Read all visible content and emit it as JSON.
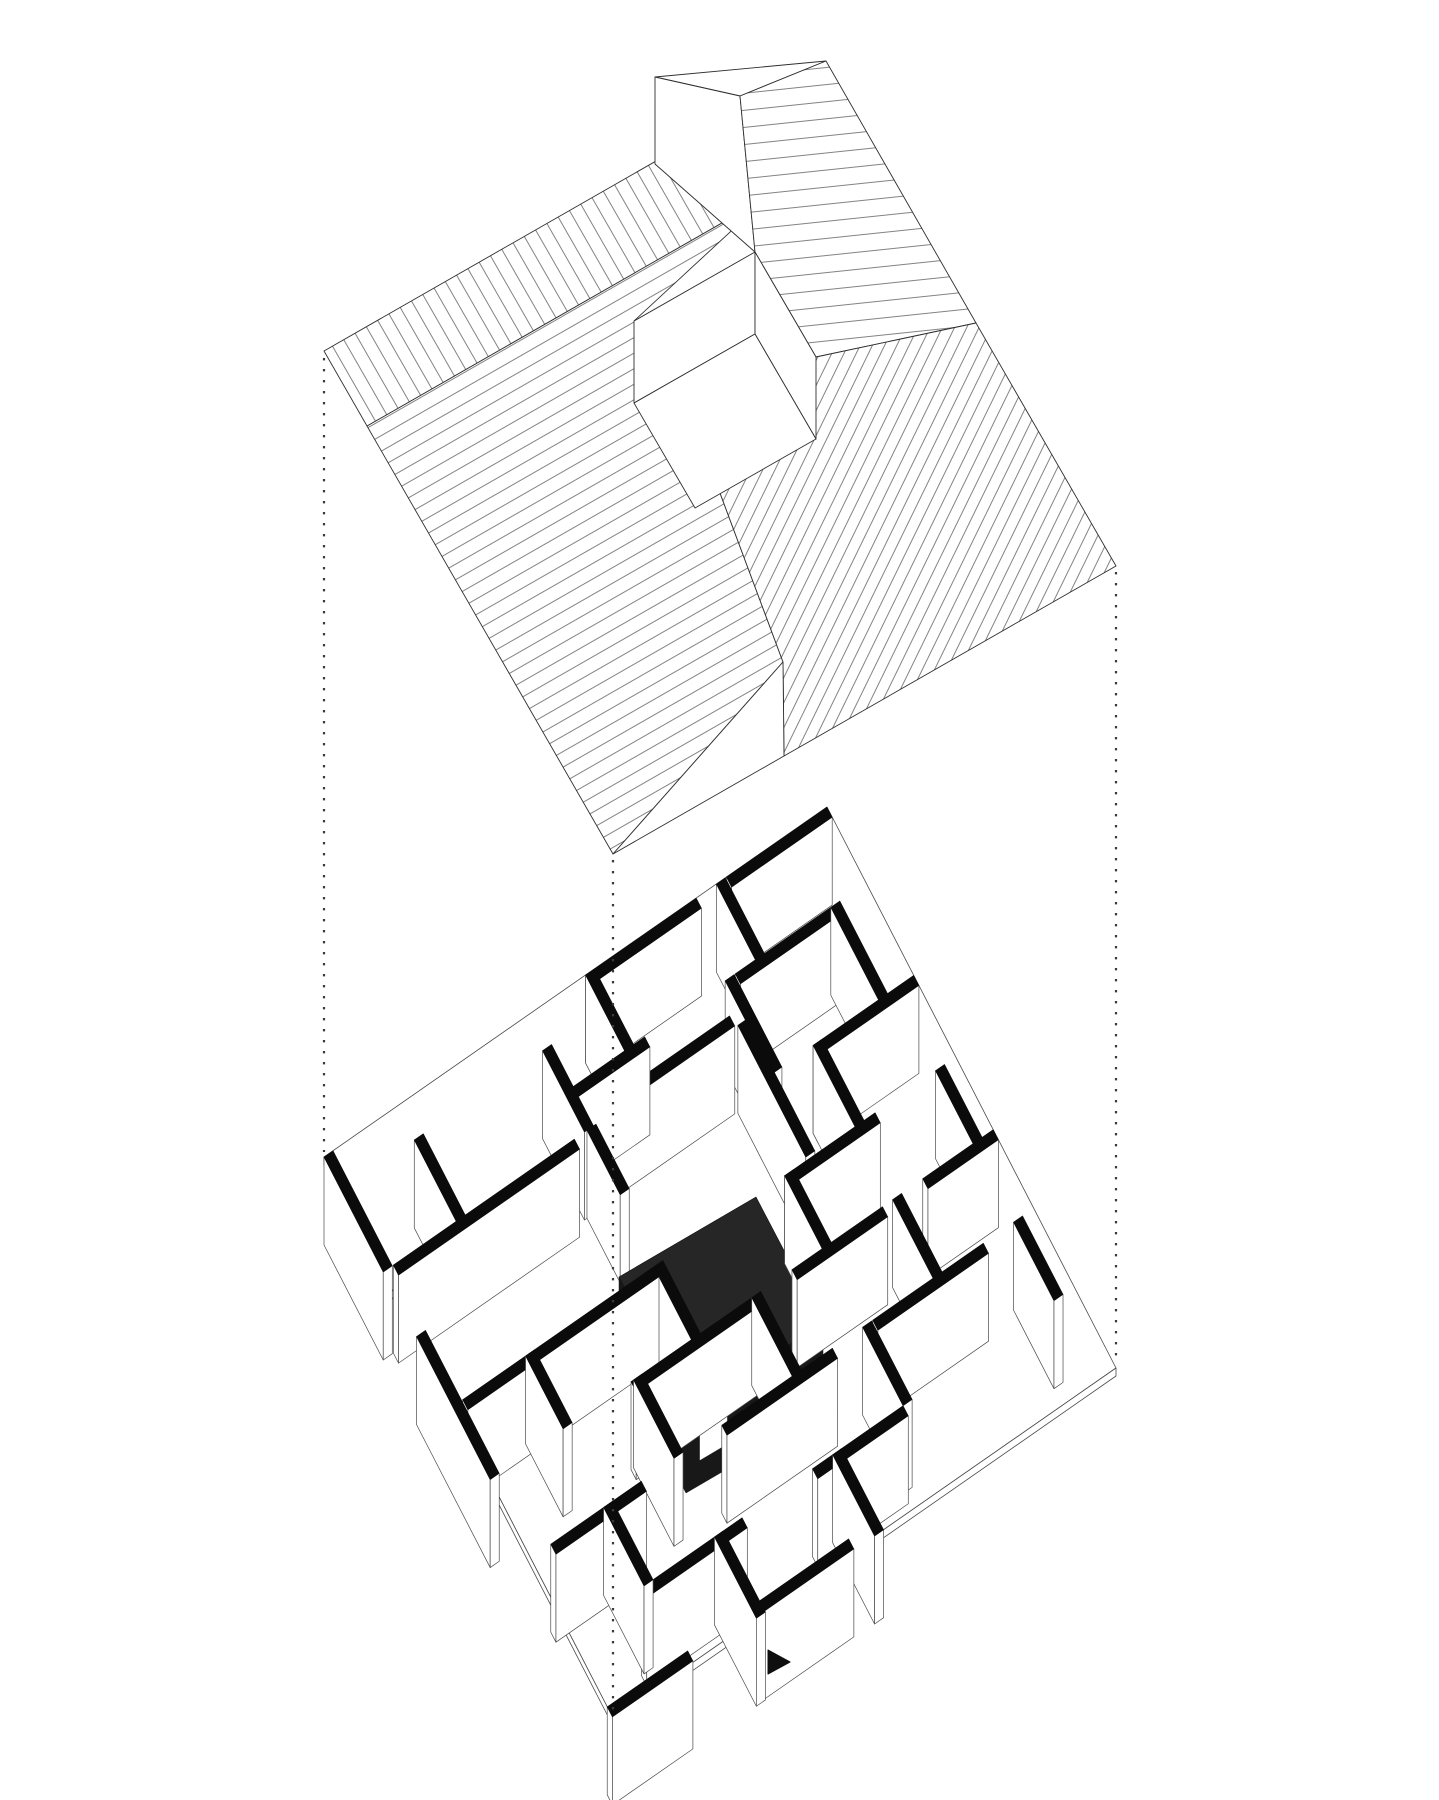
{
  "canvas": {
    "width": 1439,
    "height": 1800,
    "background": "#ffffff"
  },
  "colors": {
    "line": "#2f2f2f",
    "thin_line": "#4a4a4a",
    "hatch_line": "#5a5a5a",
    "wall_cap": "#0b0b0b",
    "wall_face": "#ffffff",
    "roof_face": "#ffffff",
    "box_top": "#262626",
    "box_face": "#181818",
    "dot": "#3a3a3a",
    "marker": "#0f0f0f"
  },
  "roof": {
    "hatches": [
      {
        "id": "hu",
        "angle": -29.8,
        "spacing": 13.5
      },
      {
        "id": "hv",
        "angle": 60.2,
        "spacing": 13
      },
      {
        "id": "hne",
        "angle": -6,
        "spacing": 17
      },
      {
        "id": "hse",
        "angle": -64,
        "spacing": 11
      }
    ],
    "planes": [
      {
        "name": "roof-slope-sw",
        "hatch": "hu",
        "points": [
          [
            367,
            426
          ],
          [
            769,
            196
          ],
          [
            634,
            321
          ],
          [
            695,
            426
          ],
          [
            783,
            662
          ],
          [
            613,
            854
          ]
        ]
      },
      {
        "name": "roof-slope-nw-band",
        "hatch": "hv",
        "points": [
          [
            324,
            351
          ],
          [
            726,
            121
          ],
          [
            769,
            196
          ],
          [
            367,
            426
          ]
        ]
      },
      {
        "name": "roof-slope-ne-far",
        "hatch": null,
        "points": [
          [
            655,
            77
          ],
          [
            826,
            61
          ],
          [
            740,
            96
          ]
        ]
      },
      {
        "name": "roof-gable-ne",
        "hatch": null,
        "points": [
          [
            655,
            77
          ],
          [
            655,
            164
          ],
          [
            755,
            252
          ],
          [
            740,
            96
          ]
        ]
      },
      {
        "name": "roof-slope-ne",
        "hatch": "hne",
        "points": [
          [
            740,
            96
          ],
          [
            826,
            61
          ],
          [
            976,
            323
          ],
          [
            816,
            357
          ],
          [
            755,
            252
          ]
        ]
      },
      {
        "name": "roof-slope-se",
        "hatch": "hse",
        "points": [
          [
            976,
            323
          ],
          [
            1116,
            566
          ],
          [
            784,
            756
          ],
          [
            783,
            662
          ],
          [
            695,
            426
          ],
          [
            816,
            357
          ]
        ]
      },
      {
        "name": "roof-gable-south",
        "hatch": null,
        "points": [
          [
            783,
            662
          ],
          [
            784,
            756
          ],
          [
            613,
            854
          ]
        ]
      },
      {
        "name": "courtyard-wall-nw",
        "hatch": null,
        "points": [
          [
            634,
            321
          ],
          [
            755,
            252
          ],
          [
            755,
            334
          ],
          [
            634,
            403
          ]
        ]
      },
      {
        "name": "courtyard-wall-ne",
        "hatch": null,
        "points": [
          [
            755,
            252
          ],
          [
            816,
            357
          ],
          [
            816,
            439
          ],
          [
            755,
            334
          ]
        ]
      },
      {
        "name": "courtyard-floor",
        "hatch": null,
        "points": [
          [
            634,
            403
          ],
          [
            755,
            334
          ],
          [
            816,
            439
          ],
          [
            695,
            508
          ]
        ]
      }
    ]
  },
  "plan": {
    "origin": [
      324,
      1157
    ],
    "axis_u": [
      503,
      -350
    ],
    "axis_v": [
      289,
      561
    ],
    "wall_height": 88,
    "cap_width": 0.018,
    "slab_thickness": 8,
    "walls_u": [
      [
        0.0,
        0.52,
        0.74
      ],
      [
        0.0,
        0.8,
        1.0
      ],
      [
        0.135,
        0.4,
        0.56
      ],
      [
        0.135,
        0.74,
        0.93
      ],
      [
        0.185,
        0.44,
        0.7
      ],
      [
        0.205,
        0.02,
        0.38
      ],
      [
        0.3,
        0.8,
        1.0
      ],
      [
        0.445,
        0.02,
        0.4
      ],
      [
        0.445,
        0.66,
        0.84
      ],
      [
        0.575,
        0.28,
        0.52
      ],
      [
        0.575,
        0.6,
        0.78
      ],
      [
        0.575,
        0.86,
        1.0
      ],
      [
        0.715,
        0.04,
        0.22
      ],
      [
        0.715,
        0.38,
        0.6
      ],
      [
        0.715,
        0.68,
        0.9
      ],
      [
        0.855,
        0.14,
        0.34
      ],
      [
        0.855,
        0.48,
        0.66
      ],
      [
        0.98,
        0.0,
        0.16
      ],
      [
        0.98,
        0.3,
        0.48
      ]
    ],
    "walls_v": [
      [
        0.0,
        0.0,
        0.205
      ],
      [
        0.0,
        0.32,
        0.575
      ],
      [
        0.145,
        0.06,
        0.205
      ],
      [
        0.145,
        0.445,
        0.575
      ],
      [
        0.145,
        0.715,
        0.855
      ],
      [
        0.285,
        0.575,
        0.715
      ],
      [
        0.285,
        0.855,
        1.0
      ],
      [
        0.4,
        0.06,
        0.205
      ],
      [
        0.405,
        0.205,
        0.32
      ],
      [
        0.4,
        0.445,
        0.575
      ],
      [
        0.52,
        0.0,
        0.135
      ],
      [
        0.52,
        0.575,
        0.715
      ],
      [
        0.52,
        0.855,
        1.0
      ],
      [
        0.705,
        0.205,
        0.44
      ],
      [
        0.66,
        0.445,
        0.575
      ],
      [
        0.66,
        0.715,
        0.855
      ],
      [
        0.72,
        0.135,
        0.3
      ],
      [
        0.78,
        0.0,
        0.135
      ],
      [
        0.8,
        0.3,
        0.445
      ],
      [
        0.8,
        0.575,
        0.715
      ],
      [
        0.93,
        0.135,
        0.3
      ],
      [
        0.96,
        0.445,
        0.575
      ],
      [
        0.96,
        0.715,
        0.855
      ]
    ],
    "box": {
      "top": [
        [
          619,
          1277
        ],
        [
          756,
          1197
        ],
        [
          823,
          1325
        ],
        [
          686,
          1405
        ]
      ],
      "height": 88,
      "sort_key": 40,
      "slits": [
        [
          [
            631,
            1300
          ],
          [
            631,
            1388
          ]
        ],
        [
          [
            639,
            1315
          ],
          [
            639,
            1403
          ]
        ]
      ],
      "notch": [
        [
          700,
          1412
        ],
        [
          727,
          1396
        ],
        [
          727,
          1444
        ],
        [
          700,
          1460
        ]
      ]
    }
  },
  "projection_lines": [
    {
      "name": "left",
      "x": 324,
      "y1": 358,
      "y2": 1152
    },
    {
      "name": "center",
      "x": 613,
      "y1": 860,
      "y2": 1712
    },
    {
      "name": "right",
      "x": 1116,
      "y1": 572,
      "y2": 1362
    }
  ],
  "marker": {
    "points": [
      [
        768,
        1650
      ],
      [
        768,
        1674
      ],
      [
        790,
        1662
      ]
    ]
  }
}
